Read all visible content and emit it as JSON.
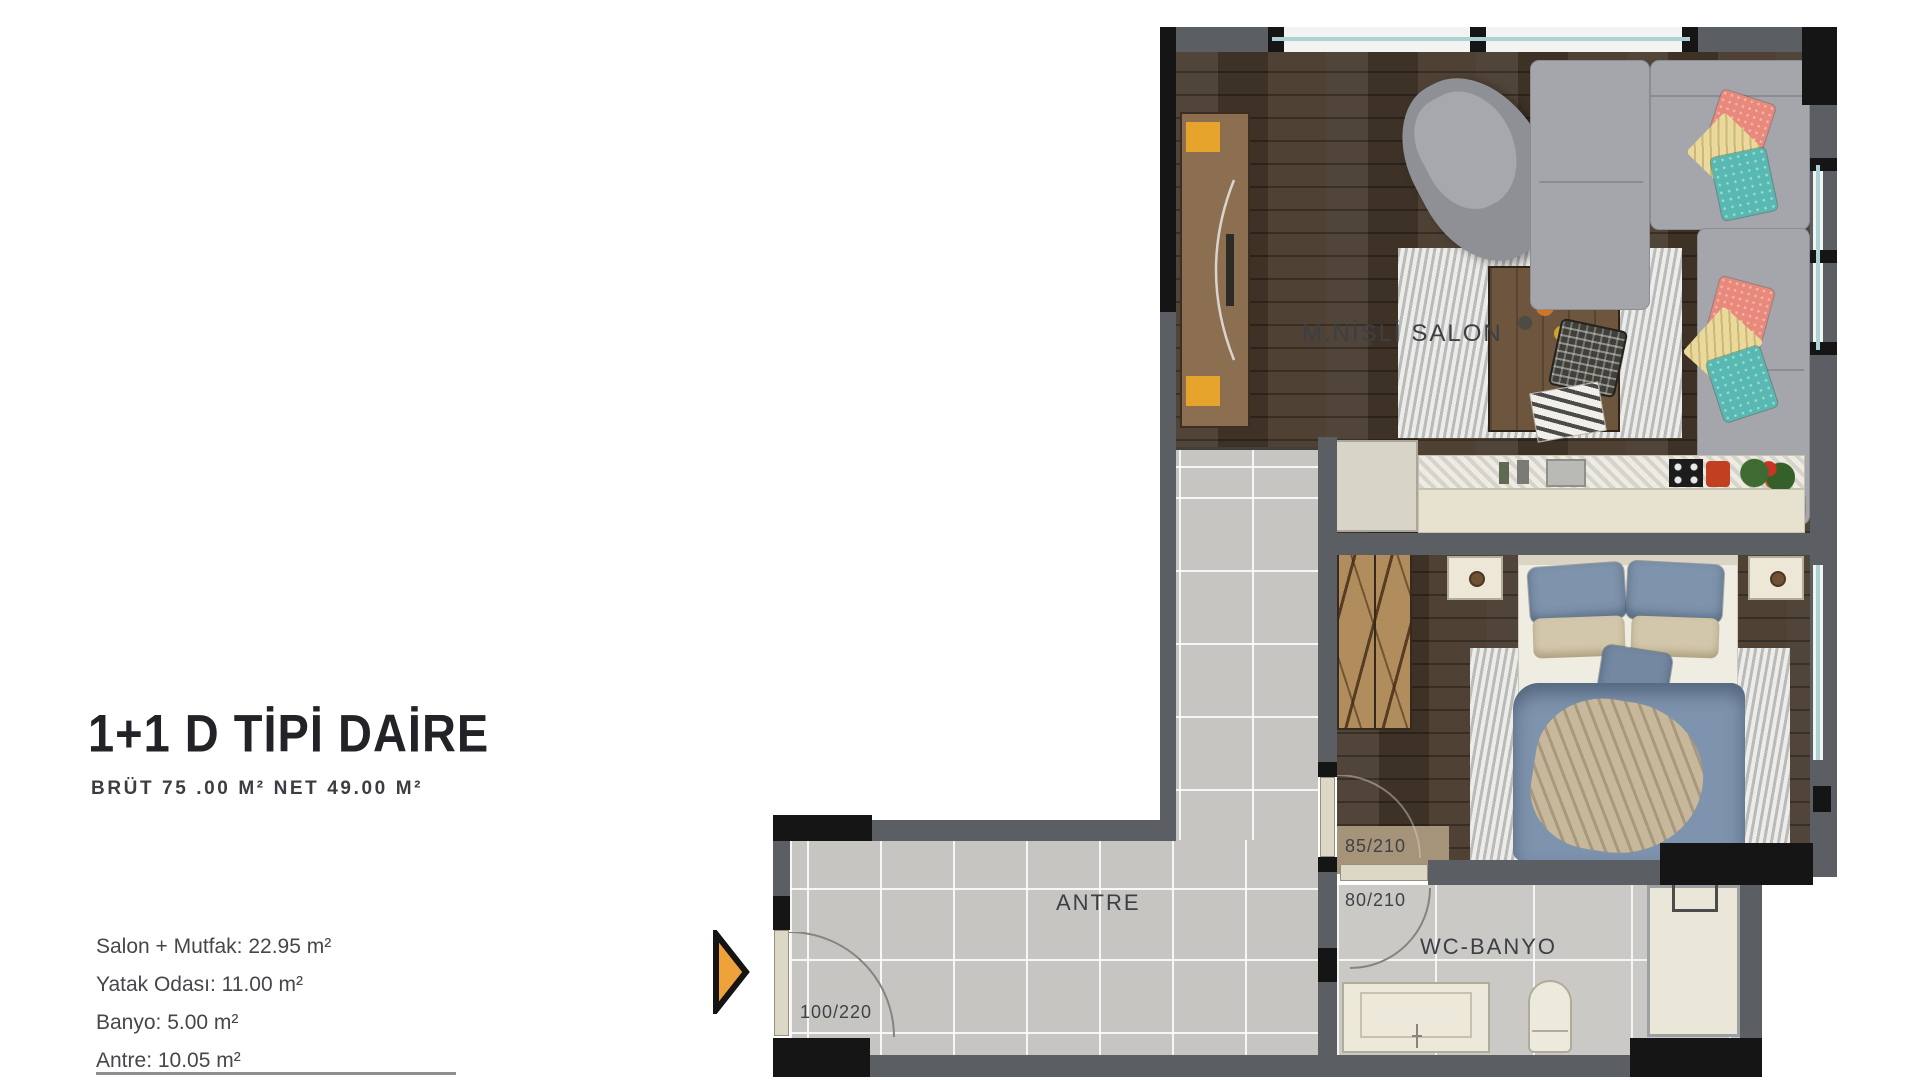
{
  "info": {
    "title": "1+1 D TİPİ DAİRE",
    "subtitle": "BRÜT 75 .00 M² NET 49.00 M²",
    "rooms": [
      "Salon + Mutfak: 22.95 m²",
      "Yatak Odası: 11.00 m²",
      "Banyo: 5.00 m²",
      "Antre: 10.05 m²"
    ]
  },
  "plan": {
    "labels": {
      "salon": "M.NİŞLİ SALON",
      "antre": "ANTRE",
      "bathroom": "WC-BANYO"
    },
    "doors": {
      "entry": "100/220",
      "bedroom": "85/210",
      "bathroom": "80/210"
    },
    "icons": {
      "entry_marker": "entry-direction-arrow"
    },
    "colors": {
      "wall_gray": "#5b5e62",
      "wall_black": "#151515",
      "wood_floor": "#483a2d",
      "tile_floor": "#c6c5c2",
      "accent_orange": "#f0a23a",
      "pillow_coral": "#e8897b",
      "pillow_teal": "#57b9b1",
      "bed_blue": "#7e93ac"
    }
  }
}
